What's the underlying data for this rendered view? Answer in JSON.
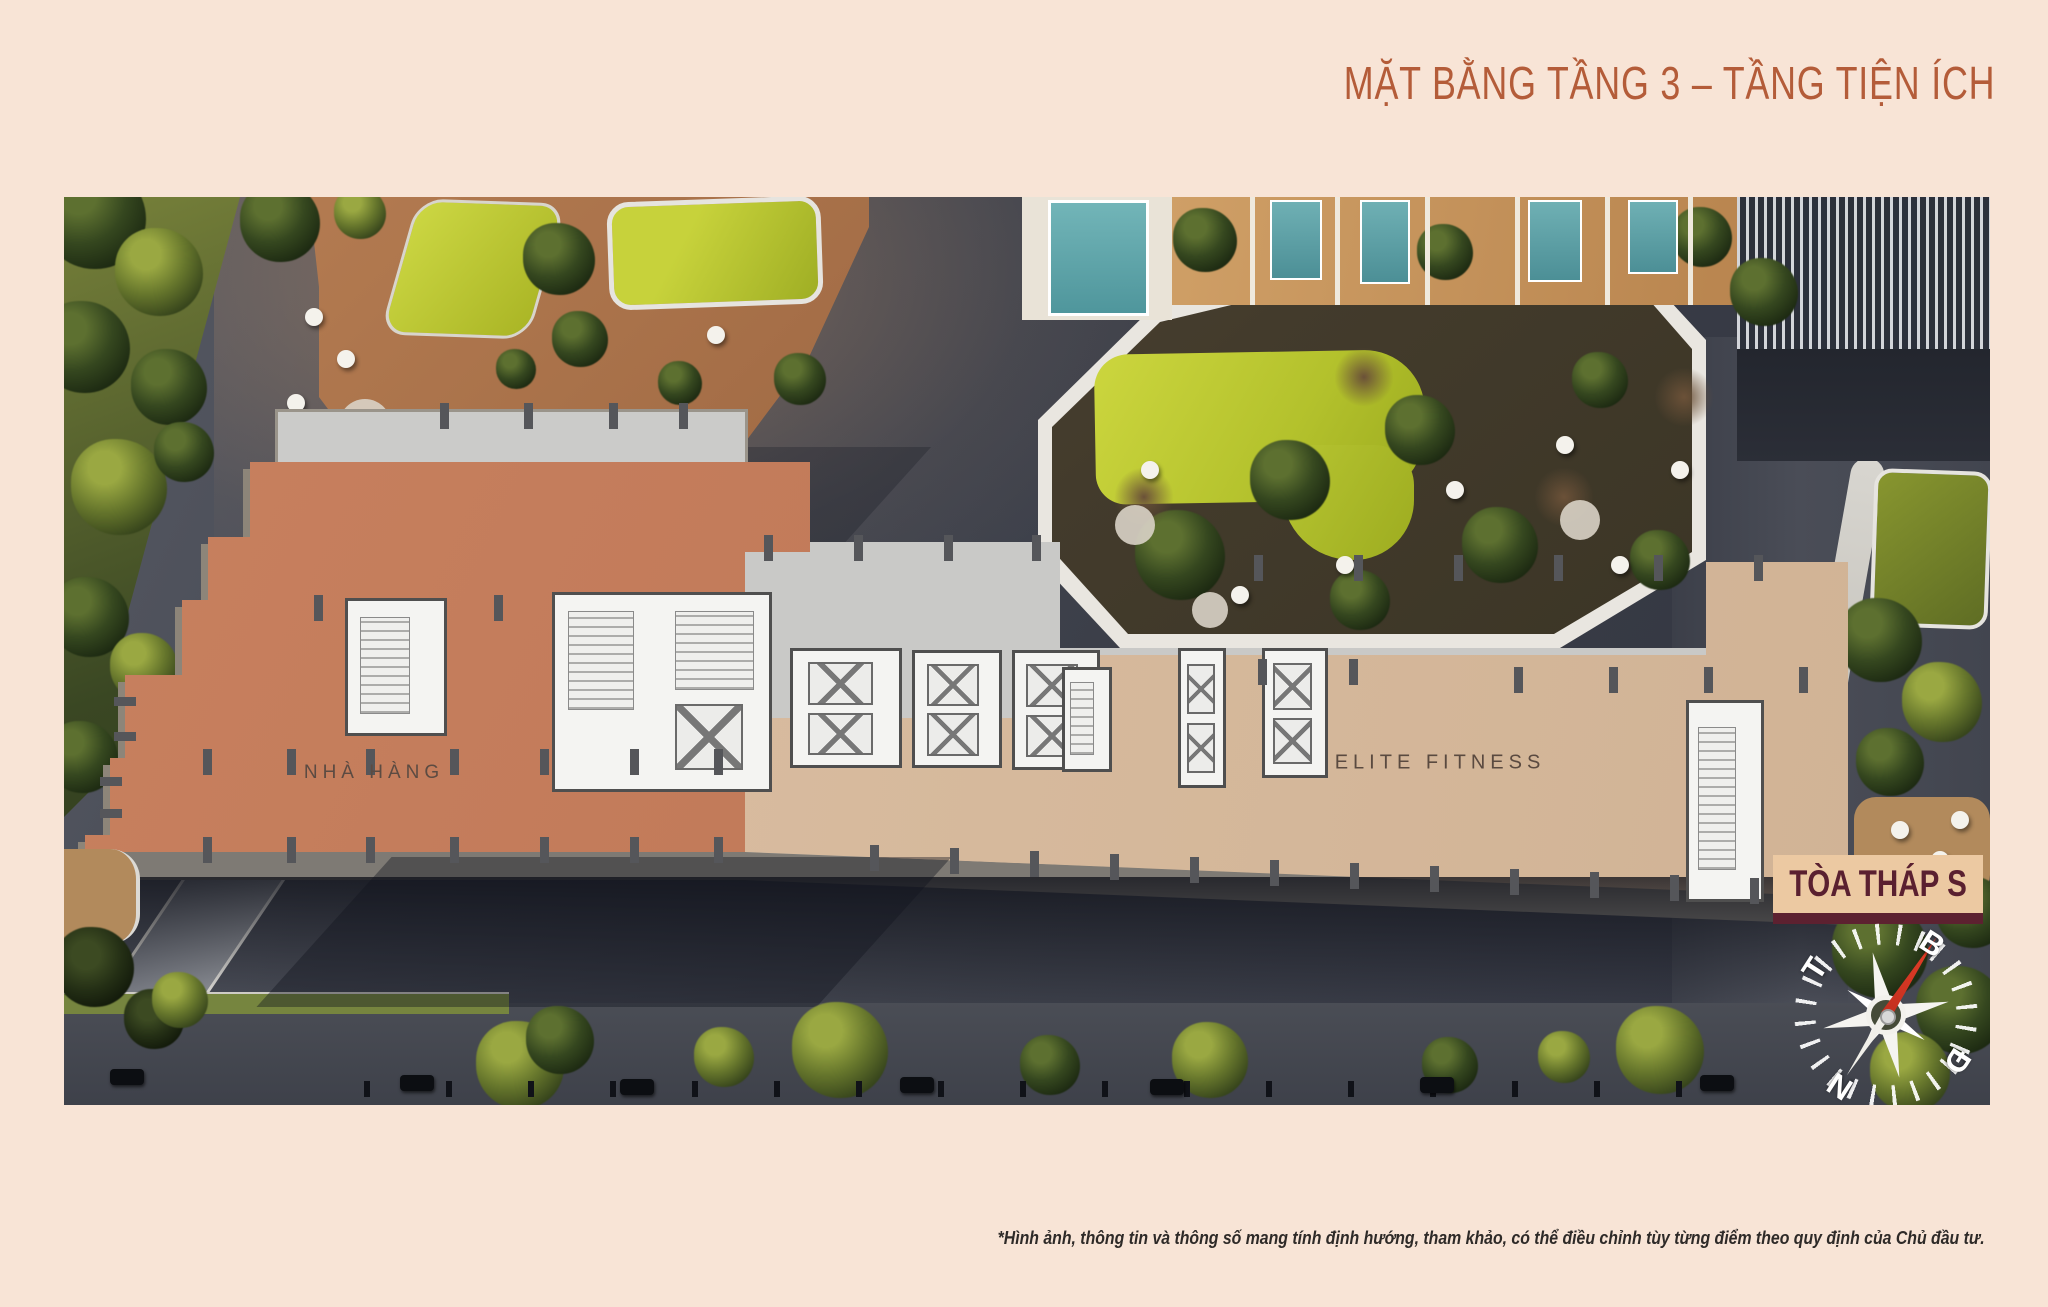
{
  "header": {
    "title": "MẶT BẰNG TẦNG 3 – TẦNG TIỆN ÍCH"
  },
  "plan": {
    "areas": [
      {
        "id": "nha-hang",
        "label": "NHÀ HÀNG",
        "color": "#c8815f"
      },
      {
        "id": "elite-fitness",
        "label": "ELITE FITNESS",
        "color": "#d9bd9f"
      }
    ],
    "tower": {
      "text": "TÒA THÁP S",
      "bg": "#ecc9a2",
      "color": "#5a2030"
    }
  },
  "compass": {
    "north": "B",
    "east": "Đ",
    "south": "N",
    "west": "T",
    "needle_color": "#d93a24"
  },
  "footer": {
    "disclaimer": "*Hình ảnh, thông tin và thông số mang tính định hướng, tham khảo, có thể điều chỉnh tùy từng điểm theo quy định của Chủ đầu tư."
  },
  "colors": {
    "background": "#f8e4d6",
    "title": "#b45c39"
  }
}
